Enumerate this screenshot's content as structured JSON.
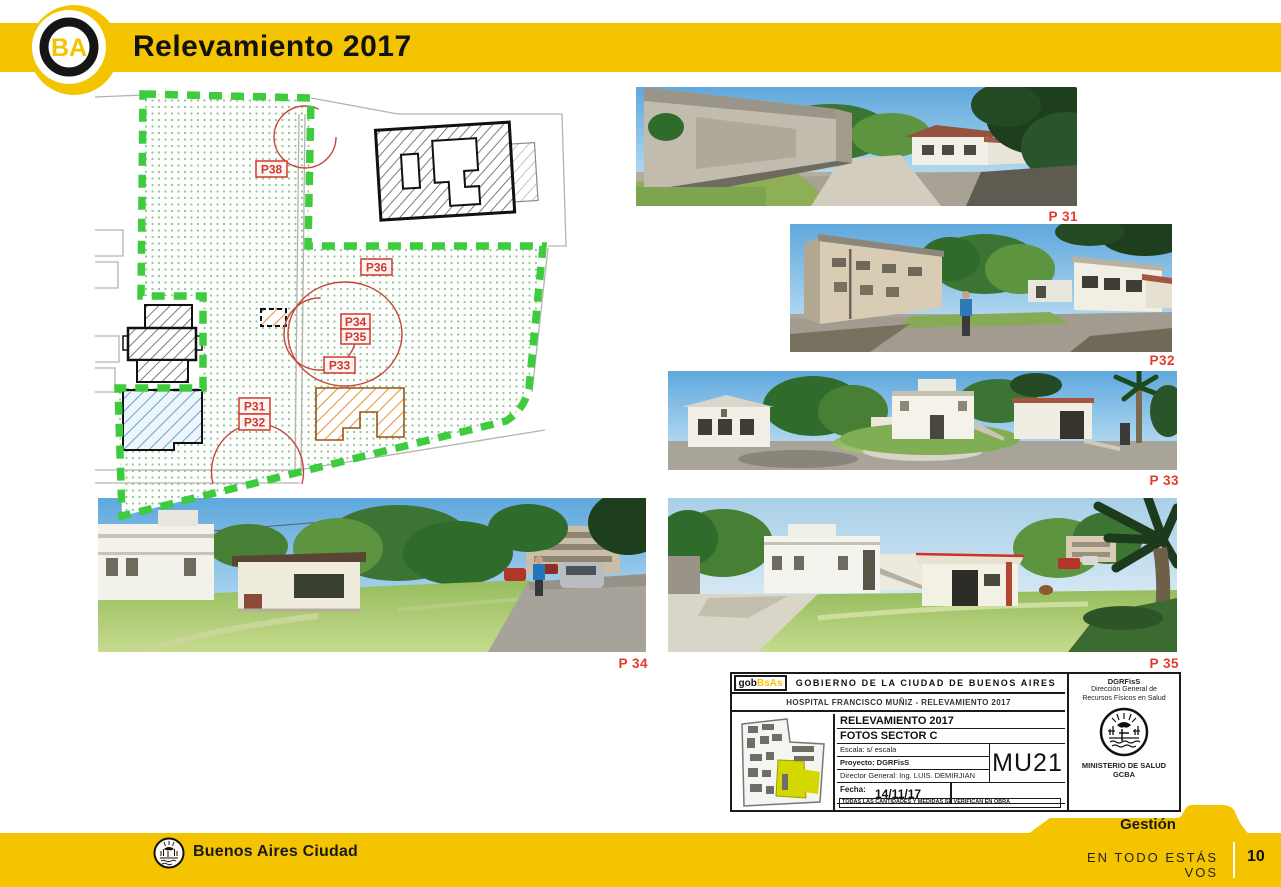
{
  "header": {
    "title": "Relevamiento 2017",
    "logo_letters": "BA"
  },
  "site_plan": {
    "labels": [
      {
        "id": "p38",
        "text": "P38"
      },
      {
        "id": "p36",
        "text": "P36"
      },
      {
        "id": "p34",
        "text": "P34"
      },
      {
        "id": "p35",
        "text": "P35"
      },
      {
        "id": "p33",
        "text": "P33"
      },
      {
        "id": "p31",
        "text": "P31"
      },
      {
        "id": "p32",
        "text": "P32"
      }
    ]
  },
  "photos": [
    {
      "id": "photo-p31",
      "label": "P 31"
    },
    {
      "id": "photo-p32",
      "label": "P32"
    },
    {
      "id": "photo-p33",
      "label": "P 33"
    },
    {
      "id": "photo-p34",
      "label": "P 34"
    },
    {
      "id": "photo-p35",
      "label": "P 35"
    }
  ],
  "title_block": {
    "logo_gob": "gob",
    "logo_bsas": "BsAs",
    "government": "GOBIERNO DE LA CIUDAD DE BUENOS AIRES",
    "project_line": "HOSPITAL FRANCISCO MUÑIZ - RELEVAMIENTO 2017",
    "rows": {
      "title1": "RELEVAMIENTO 2017",
      "title2": "FOTOS SECTOR C",
      "escala": "Escala: s/ escala",
      "proyecto": "Proyecto: DGRFisS",
      "director": "Director General: Ing. LUIS. DEMIRJIAN",
      "fecha_label": "Fecha:",
      "fecha_value": "14/11/17",
      "disclaimer": "TODAS LAS CANTIDADES Y MEDIDAS SE VERIFICAN EN OBRA"
    },
    "sheet_code": "MU21",
    "right_column": {
      "line1": "DGRFisS",
      "line2": "Dirección General de",
      "line3": "Recursos Físicos en Salud",
      "ministry": "MINISTERIO DE SALUD",
      "org": "GCBA"
    }
  },
  "footer": {
    "gestion": "Gestión",
    "brand": "Buenos Aires Ciudad",
    "slogan": "EN TODO ESTÁS VOS",
    "page_number": "10"
  },
  "colors": {
    "brand_yellow": "#F5C400",
    "plan_green": "#3ECB3E",
    "label_red": "#D0392C",
    "photo_label_red": "#E8392E"
  }
}
